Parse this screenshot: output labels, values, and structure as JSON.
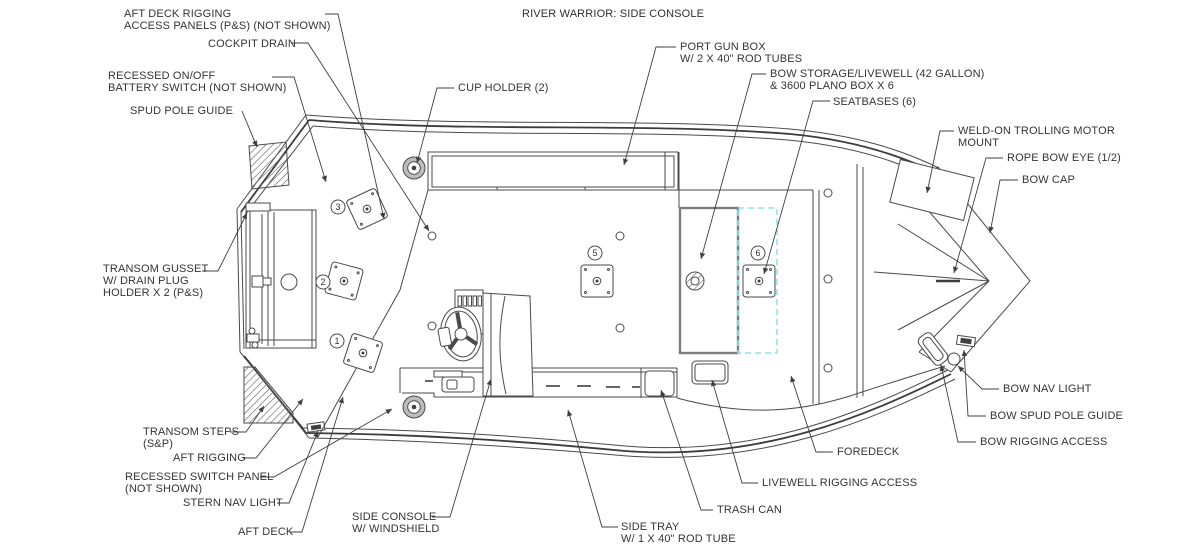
{
  "title": "RIVER WARRIOR: SIDE CONSOLE",
  "labels": {
    "aft_deck_rigging_access": "AFT DECK RIGGING\nACCESS PANELS (P&S) (NOT SHOWN)",
    "cockpit_drain": "COCKPIT DRAIN",
    "recessed_battery_switch": "RECESSED ON/OFF\nBATTERY SWITCH (NOT SHOWN)",
    "spud_pole_guide": "SPUD POLE GUIDE",
    "cup_holder": "CUP HOLDER (2)",
    "port_gun_box": "PORT GUN BOX\nW/ 2 X 40\" ROD TUBES",
    "bow_storage_livewell": "BOW STORAGE/LIVEWELL (42 GALLON)\n& 3600 PLANO BOX X 6",
    "seatbases": "SEATBASES (6)",
    "weld_on_trolling_motor": "WELD-ON TROLLING MOTOR\nMOUNT",
    "rope_bow_eye": "ROPE BOW EYE (1/2)",
    "bow_cap": "BOW CAP",
    "transom_gusset": "TRANSOM GUSSET\nW/ DRAIN PLUG\nHOLDER X 2 (P&S)",
    "bow_nav_light": "BOW NAV LIGHT",
    "bow_spud_pole_guide": "BOW SPUD POLE GUIDE",
    "bow_rigging_access": "BOW RIGGING ACCESS",
    "transom_steps": "TRANSOM STEPS\n(S&P)",
    "foredeck": "FOREDECK",
    "aft_rigging": "AFT RIGGING",
    "recessed_switch_panel": "RECESSED SWITCH PANEL\n(NOT SHOWN)",
    "stern_nav_light": "STERN NAV LIGHT",
    "trash_can": "TRASH CAN",
    "side_console": "SIDE CONSOLE\nW/ WINDSHIELD",
    "side_tray": "SIDE TRAY\nW/ 1 X 40\" ROD TUBE",
    "aft_deck": "AFT DECK",
    "livewell_rigging_access": "LIVEWELL RIGGING ACCESS"
  },
  "seat_numbers": {
    "s1": "1",
    "s2": "2",
    "s3": "3",
    "s5": "5",
    "s6": "6"
  },
  "colors": {
    "line": "#4a4a4a",
    "text": "#343434",
    "livewell_dash": "#8ee4ec"
  }
}
